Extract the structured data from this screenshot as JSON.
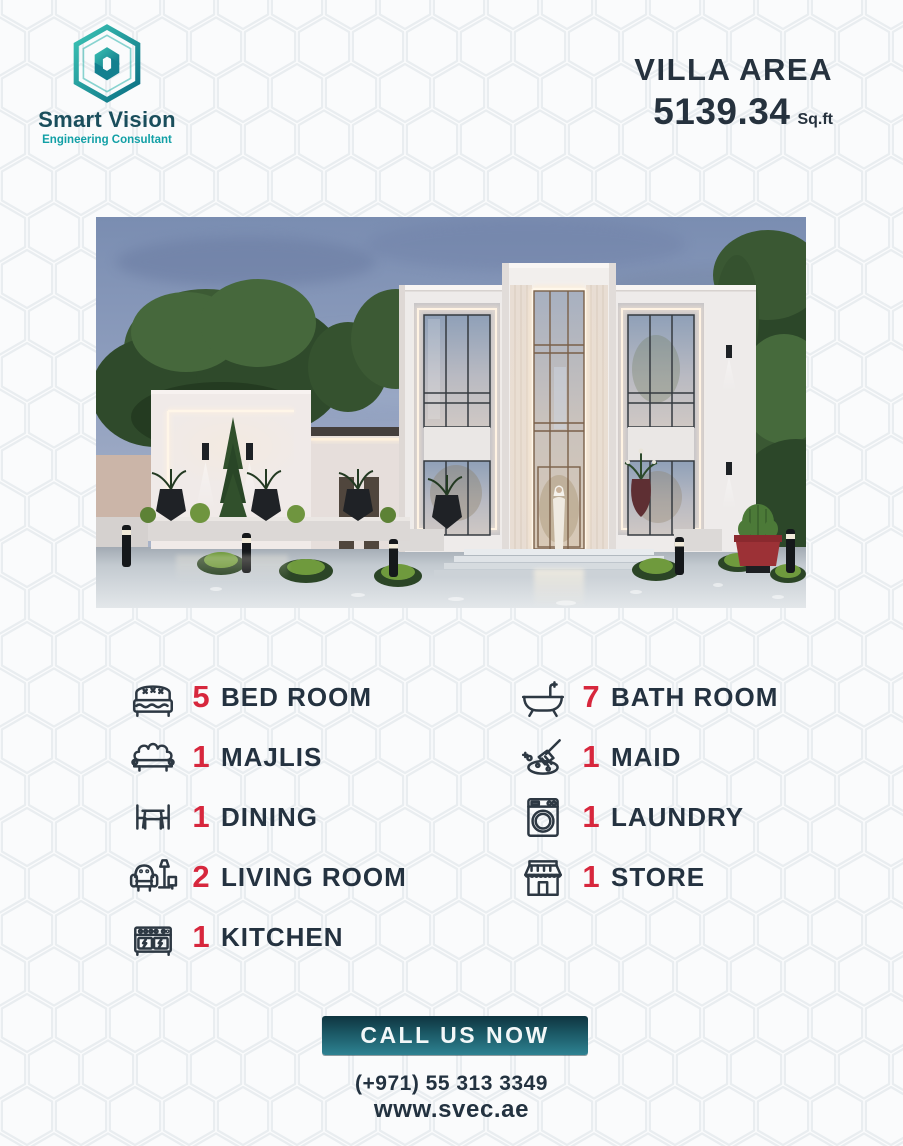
{
  "brand": {
    "name": "Smart Vision",
    "tagline": "Engineering Consultant",
    "logo_icon": "hexagon-s-icon",
    "colors": {
      "teal_light": "#39c1b4",
      "teal_dark": "#0a6e83",
      "name_color": "#1a4e5c",
      "tagline_color": "#12a0a6"
    }
  },
  "header": {
    "villa_area_label": "VILLA AREA",
    "villa_area_value": "5139.34",
    "villa_area_unit": "Sq.ft"
  },
  "features": {
    "left": [
      {
        "count": "5",
        "label": "BED ROOM",
        "icon": "bed-icon"
      },
      {
        "count": "1",
        "label": "MAJLIS",
        "icon": "sofa-icon"
      },
      {
        "count": "1",
        "label": "DINING",
        "icon": "dining-table-icon"
      },
      {
        "count": "2",
        "label": "LIVING ROOM",
        "icon": "armchair-icon"
      },
      {
        "count": "1",
        "label": "KITCHEN",
        "icon": "stove-icon"
      }
    ],
    "right": [
      {
        "count": "7",
        "label": "BATH ROOM",
        "icon": "bathtub-icon"
      },
      {
        "count": "1",
        "label": "MAID",
        "icon": "cleaning-brush-icon"
      },
      {
        "count": "1",
        "label": "LAUNDRY",
        "icon": "washing-machine-icon"
      },
      {
        "count": "1",
        "label": "STORE",
        "icon": "store-icon"
      }
    ],
    "count_color": "#d7273d",
    "label_color": "#243240"
  },
  "footer": {
    "cta_label": "CALL US NOW",
    "cta_gradient": [
      "#0f3540",
      "#2e8292"
    ],
    "phone": "(+971) 55 313 3349",
    "website": "www.svec.ae"
  }
}
